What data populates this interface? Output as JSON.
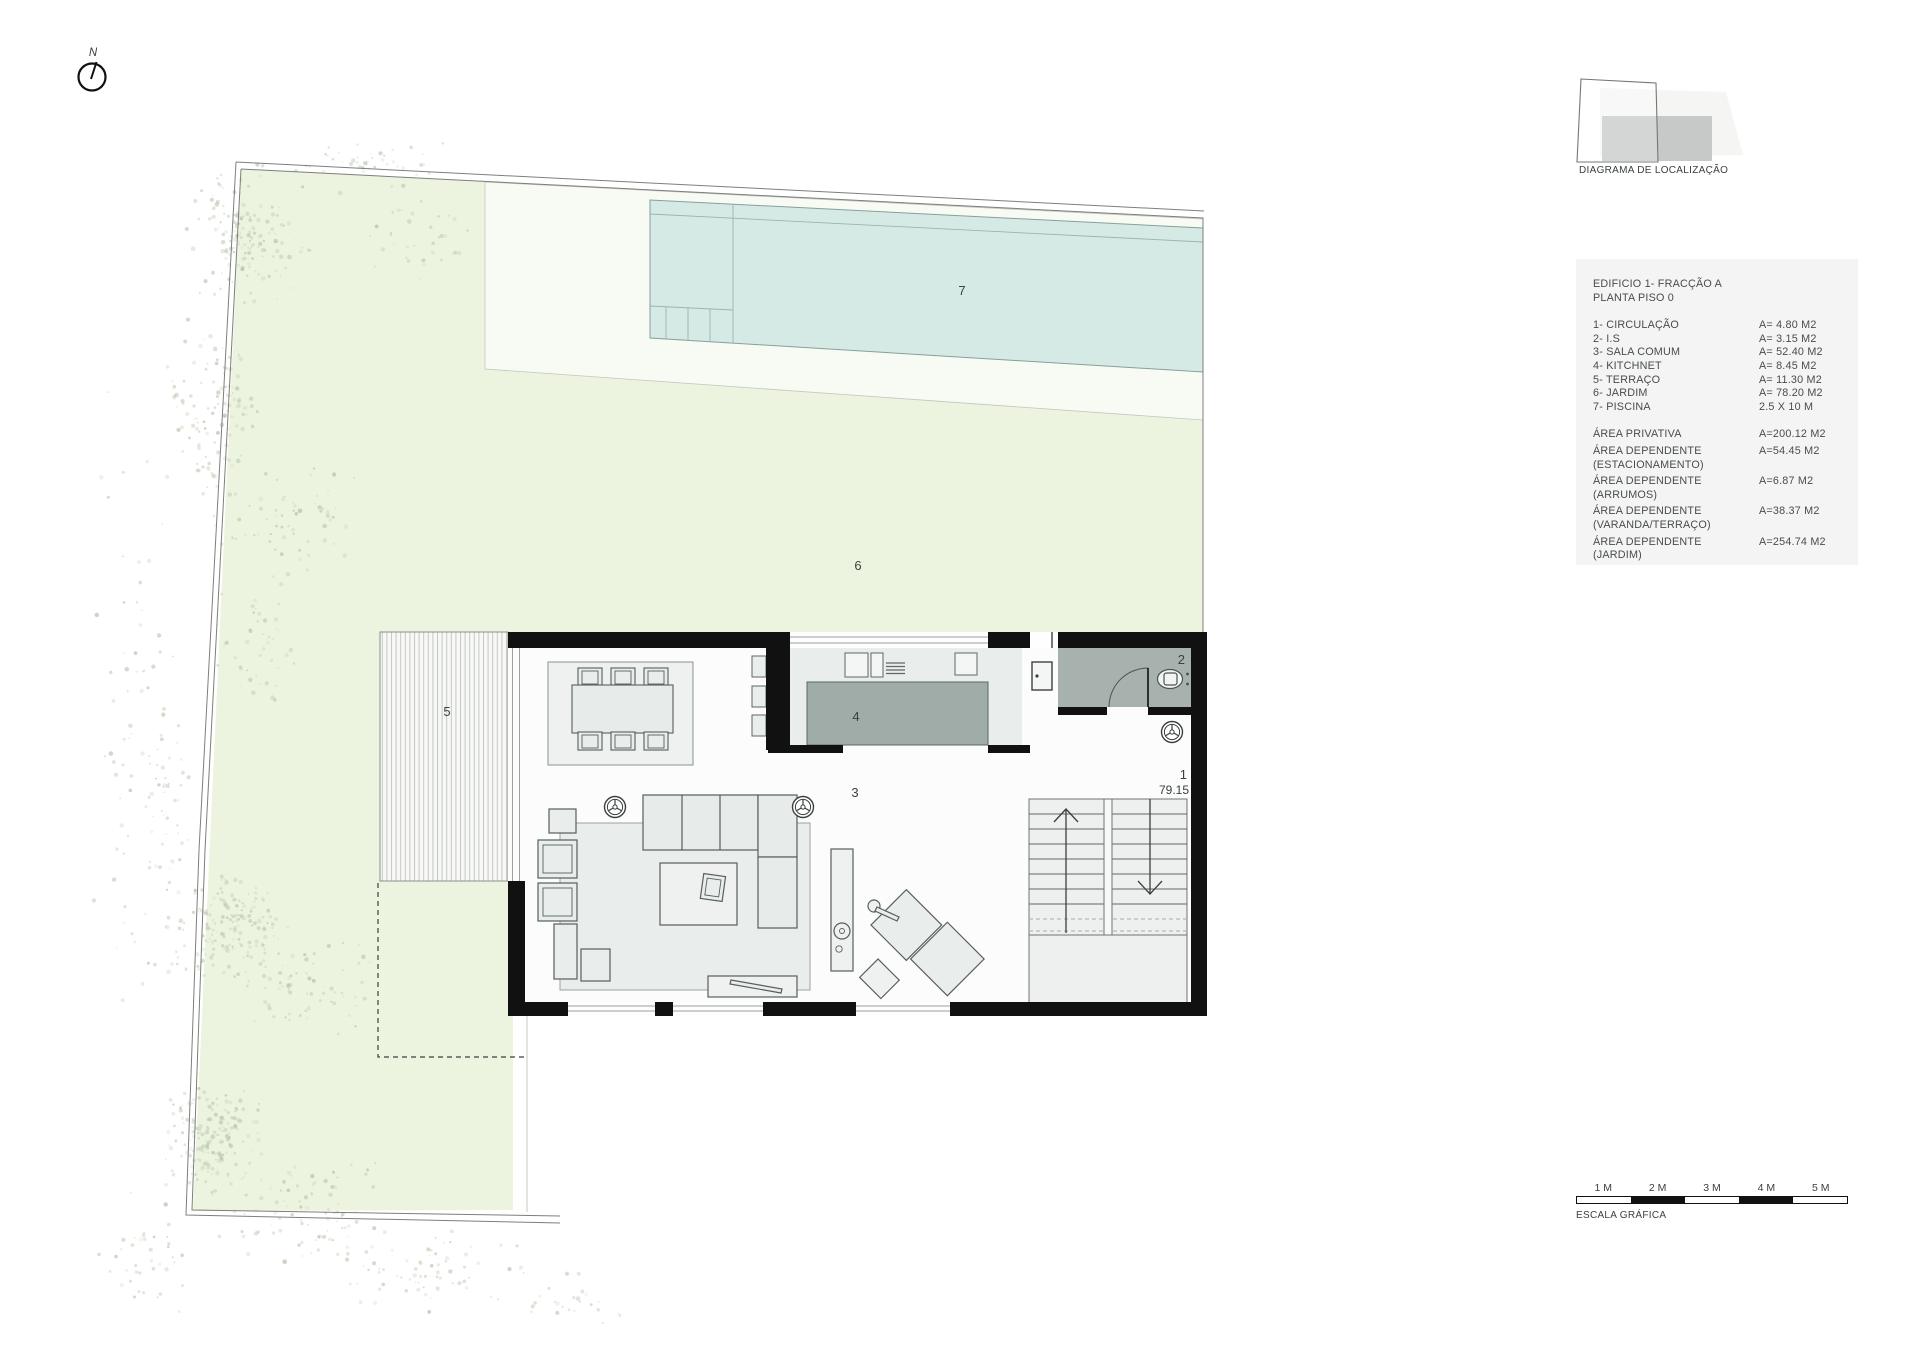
{
  "north": {
    "label": "N"
  },
  "location_diagram": {
    "title": "DIAGRAMA DE LOCALIZAÇÃO"
  },
  "legend": {
    "title_line1": "EDIFICIO 1- FRACÇÃO A",
    "title_line2": "PLANTA PISO 0",
    "rooms": [
      {
        "label": "1- CIRCULAÇÃO",
        "area": "A= 4.80 M2"
      },
      {
        "label": "2- I.S",
        "area": "A= 3.15 M2"
      },
      {
        "label": "3- SALA COMUM",
        "area": "A= 52.40 M2"
      },
      {
        "label": "4- KITCHNET",
        "area": "A= 8.45 M2"
      },
      {
        "label": "5- TERRAÇO",
        "area": "A= 11.30 M2"
      },
      {
        "label": "6- JARDIM",
        "area": "A= 78.20 M2"
      },
      {
        "label": "7- PISCINA",
        "area": "2.5 X 10 M"
      }
    ],
    "areas": [
      {
        "line1": "ÁREA PRIVATIVA",
        "line2": "",
        "value": "A=200.12 M2"
      },
      {
        "line1": "ÁREA DEPENDENTE",
        "line2": "(ESTACIONAMENTO)",
        "value": "A=54.45 M2"
      },
      {
        "line1": "ÁREA DEPENDENTE",
        "line2": "(ARRUMOS)",
        "value": "A=6.87 M2"
      },
      {
        "line1": "ÁREA DEPENDENTE",
        "line2": "(VARANDA/TERRAÇO)",
        "value": "A=38.37 M2"
      },
      {
        "line1": "ÁREA DEPENDENTE",
        "line2": "(JARDIM)",
        "value": "A=254.74 M2"
      }
    ]
  },
  "plan_labels": {
    "circulation": "1",
    "level": "79.15",
    "bathroom": "2",
    "living": "3",
    "kitchen": "4",
    "terrace": "5",
    "garden": "6",
    "pool": "7"
  },
  "scale_bar": {
    "title": "ESCALA GRÁFICA",
    "ticks": [
      "1 M",
      "2 M",
      "3 M",
      "4 M",
      "5 M"
    ]
  },
  "colors": {
    "wall": "#111111",
    "pool_water": "#d6eae5",
    "garden": "#ecf3df",
    "deck": "#f8faf4",
    "island": "#9faca8",
    "bathroom_floor": "#a7b2af",
    "furniture_fill": "#e9eeec",
    "legend": "#f4f4f4",
    "text": "#3b4241"
  }
}
